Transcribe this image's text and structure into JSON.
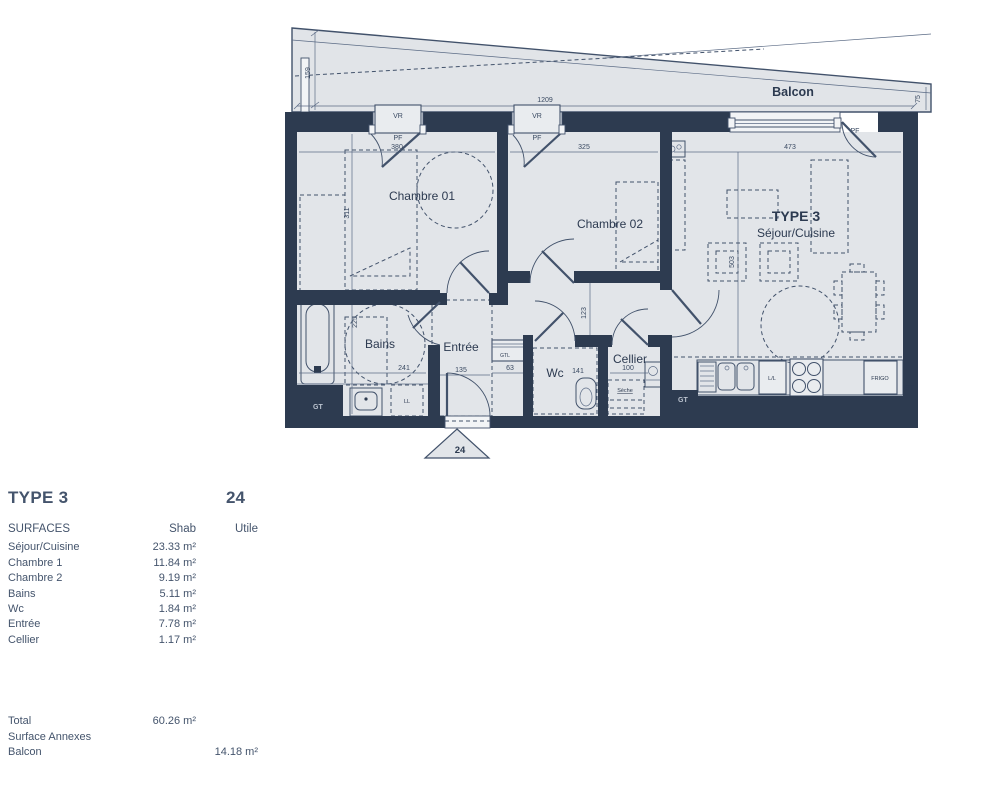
{
  "plan": {
    "balcon": "Balcon",
    "dim_balcon_w": "1209",
    "dim_balcon_l": "159",
    "dim_balcon_r": "75",
    "chambre1": "Chambre 01",
    "dim_ch1_w": "380",
    "dim_ch1_h": "311",
    "chambre2": "Chambre 02",
    "dim_ch2_w": "325",
    "type_label": "TYPE 3",
    "sejour": "Séjour/Cuisine",
    "dim_sej_w": "473",
    "dim_sej_h": "503",
    "bains": "Bains",
    "dim_bains_w": "241",
    "dim_bains_h": "225",
    "entree": "Entrée",
    "dim_entree": "135",
    "wc": "Wc",
    "dim_wc": "141",
    "dim_niche": "63",
    "dim_couloir": "123",
    "cellier": "Cellier",
    "dim_cellier": "100",
    "seche": "Sèche",
    "vr": "VR",
    "pf": "PF",
    "gt": "GT",
    "gtl": "GTL",
    "ll_bains": "LL",
    "lave": "L/L",
    "frigo": "FRIGO",
    "unit_marker": "24"
  },
  "table": {
    "title": "TYPE 3",
    "unit": "24",
    "headers": {
      "col": "SURFACES",
      "shab": "Shab",
      "utile": "Utile"
    },
    "rows": [
      {
        "label": "Séjour/Cuisine",
        "shab": "23.33 m²",
        "utile": ""
      },
      {
        "label": "Chambre 1",
        "shab": "11.84 m²",
        "utile": ""
      },
      {
        "label": "Chambre 2",
        "shab": "9.19 m²",
        "utile": ""
      },
      {
        "label": "Bains",
        "shab": "5.11 m²",
        "utile": ""
      },
      {
        "label": "Wc",
        "shab": "1.84 m²",
        "utile": ""
      },
      {
        "label": "Entrée",
        "shab": "7.78 m²",
        "utile": ""
      },
      {
        "label": "Cellier",
        "shab": "1.17 m²",
        "utile": ""
      }
    ],
    "total": {
      "label": "Total",
      "shab": "60.26 m²"
    },
    "annexes": {
      "label": "Surface Annexes"
    },
    "balcon": {
      "label": "Balcon",
      "utile": "14.18 m²"
    },
    "colors": {
      "wall": "#2d3b50",
      "room": "#e2e5e9",
      "text": "#44546c"
    }
  }
}
